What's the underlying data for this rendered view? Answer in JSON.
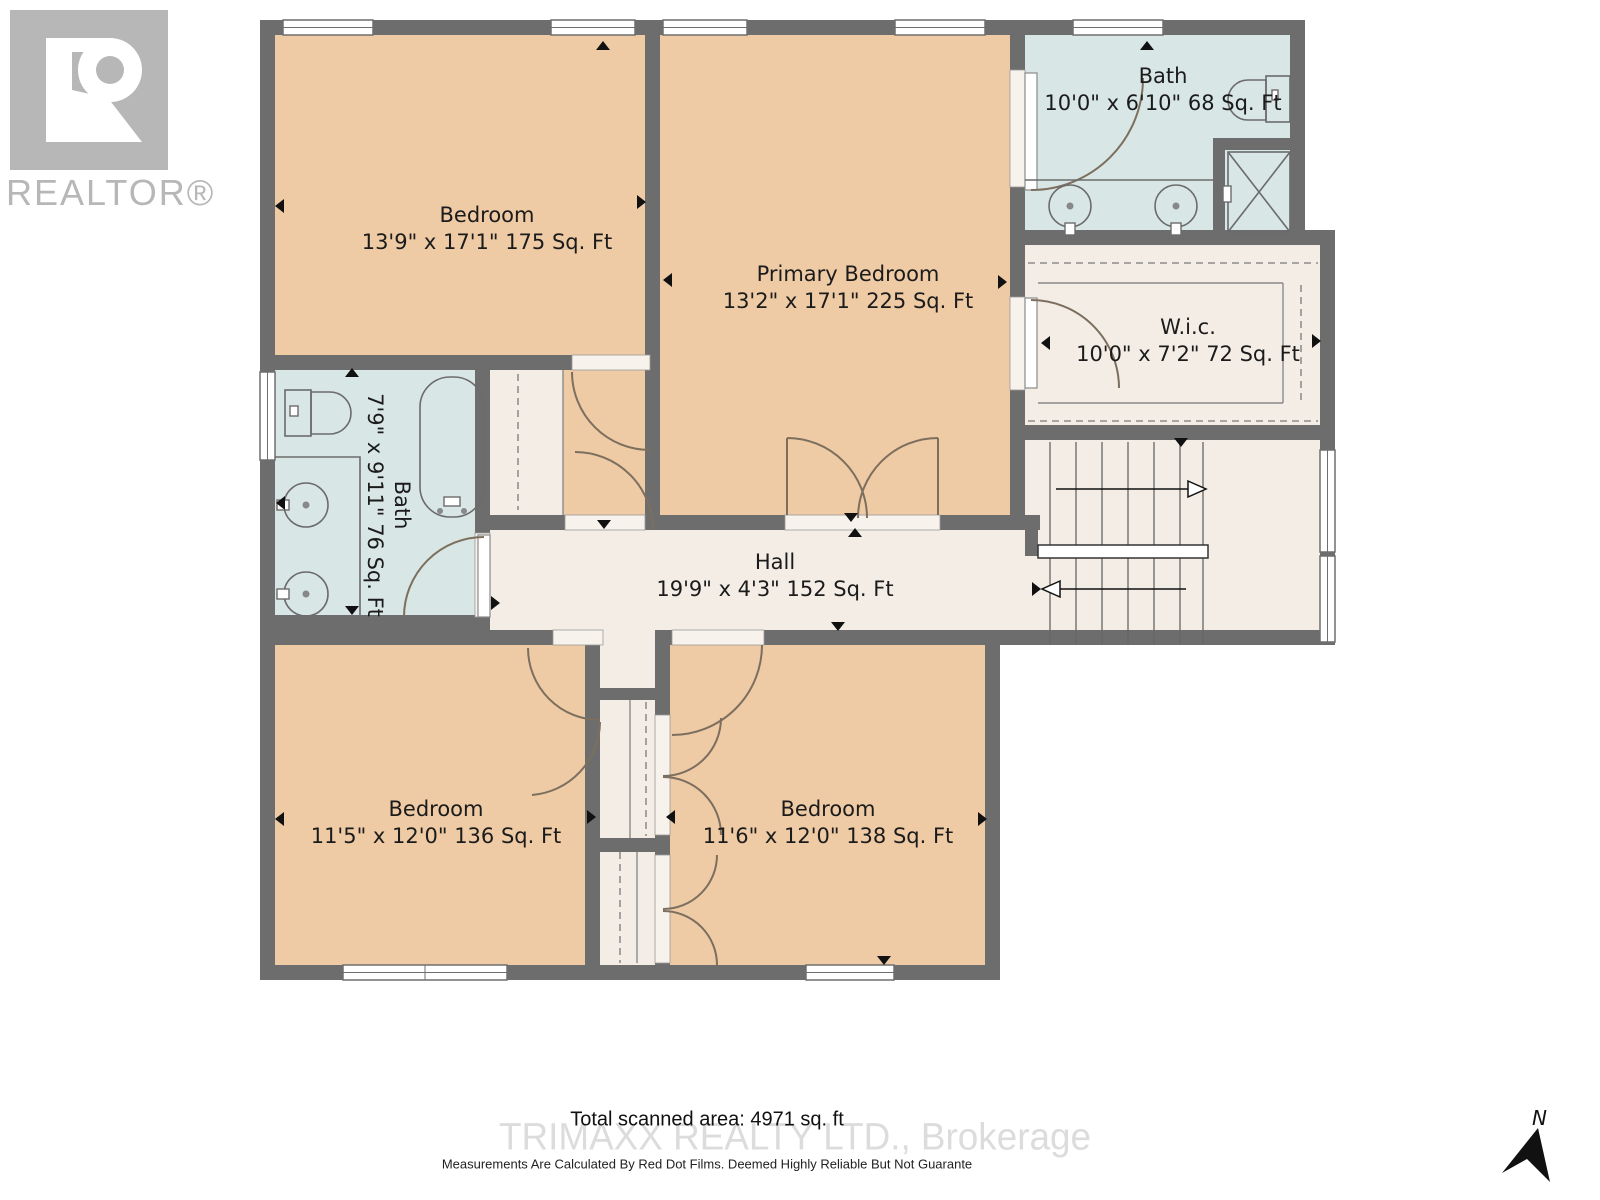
{
  "branding": {
    "logo_text": "REALTOR®"
  },
  "rooms": [
    {
      "name": "Bedroom",
      "dims": "13'9\" x 17'1\" 175 Sq. Ft"
    },
    {
      "name": "Primary Bedroom",
      "dims": "13'2\" x 17'1\" 225 Sq. Ft"
    },
    {
      "name": "Bath",
      "dims": "10'0\" x 6'10\" 68 Sq. Ft"
    },
    {
      "name": "W.i.c.",
      "dims": "10'0\" x 7'2\" 72 Sq. Ft"
    },
    {
      "name": "Bath",
      "dims": "7'9\" x 9'11\" 76 Sq. Ft"
    },
    {
      "name": "Hall",
      "dims": "19'9\" x 4'3\" 152 Sq. Ft"
    },
    {
      "name": "Bedroom",
      "dims": "11'5\" x 12'0\" 136 Sq. Ft"
    },
    {
      "name": "Bedroom",
      "dims": "11'6\" x 12'0\" 138 Sq. Ft"
    }
  ],
  "footer": {
    "total_area": "Total scanned area: 4971 sq. ft",
    "watermark": "TRIMAXX REALTY LTD., Brokerage",
    "disclaimer": "Measurements Are Calculated By Red Dot Films. Deemed Highly Reliable But Not Guarante"
  },
  "compass": {
    "north_label": "N"
  },
  "colors": {
    "wall": "#6d6d6d",
    "bedroom_fill": "#eecaa5",
    "bath_fill": "#d8e6e5",
    "neutral_fill": "#f3ede6",
    "watermark_gray": "#dcdcdc",
    "logo_gray": "#b7b7b7"
  }
}
